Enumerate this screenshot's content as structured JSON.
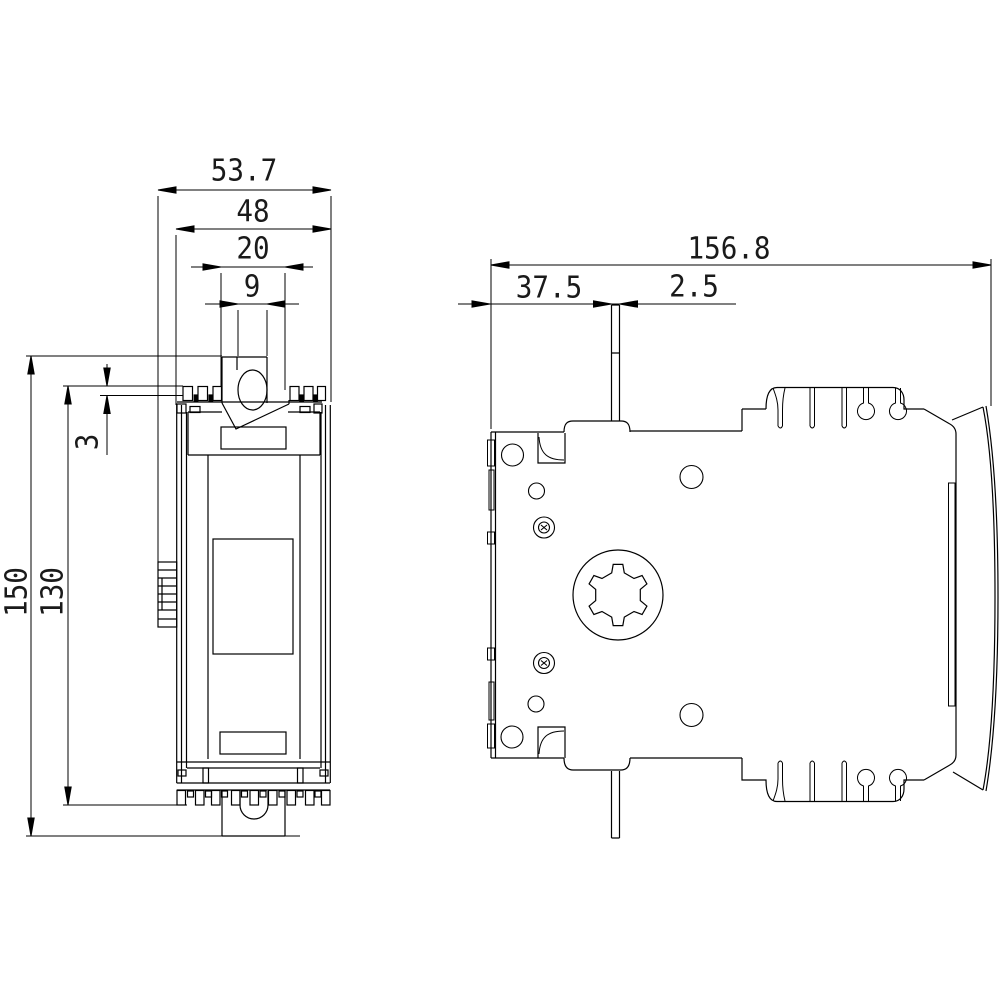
{
  "dims": {
    "front_overall_width": "53.7",
    "front_body_width": "48",
    "front_slot_width": "20",
    "front_lever_width": "9",
    "front_overall_height": "150",
    "front_body_height": "130",
    "front_rail_offset": "3",
    "side_overall_depth": "156.8",
    "side_lever_offset": "37.5",
    "side_lever_thickness": "2.5"
  },
  "style": {
    "line_color": "#000000",
    "background": "#ffffff",
    "text_color": "#1a1a1a"
  }
}
